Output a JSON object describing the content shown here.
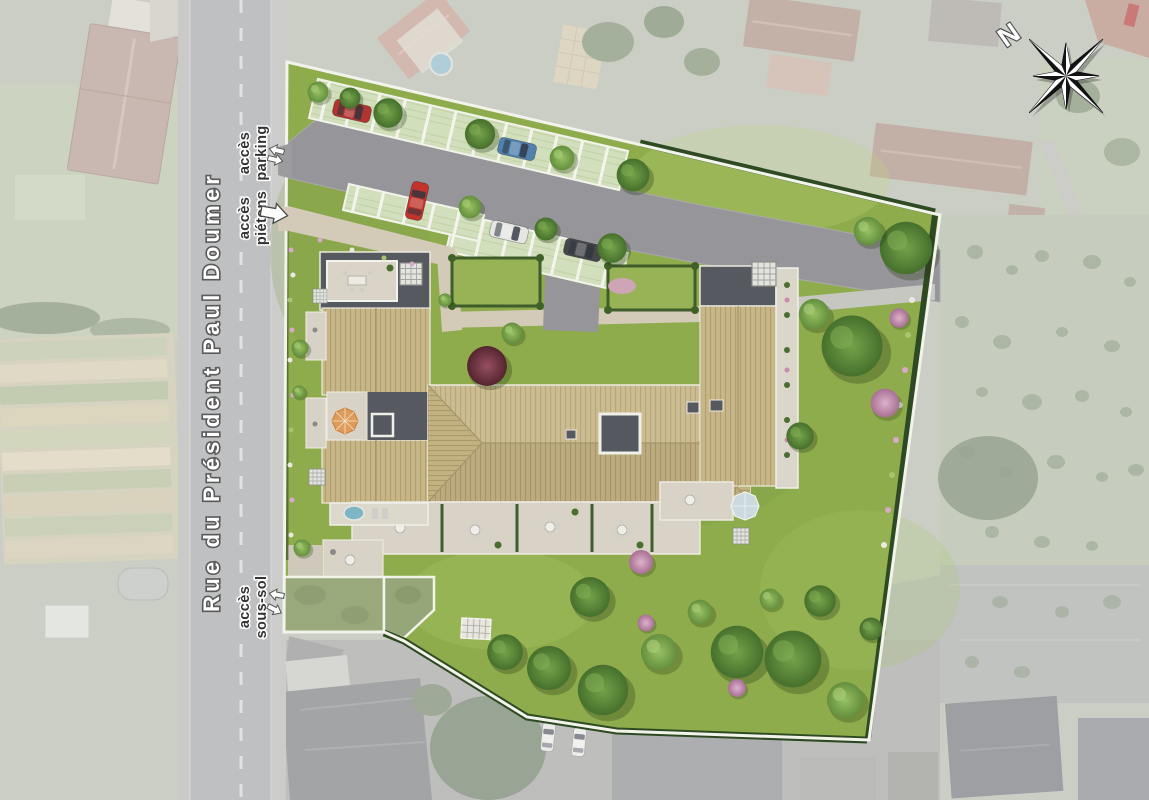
{
  "site_plan": {
    "street_name": "Rue du Président Paul Doumer",
    "access_labels": {
      "parking": [
        "accès",
        "parking"
      ],
      "pedestrian": [
        "accès",
        "piétons"
      ],
      "basement": [
        "accès",
        "sous-sol"
      ]
    },
    "compass": {
      "north_label": "N"
    },
    "palette": {
      "lawn": "#8fac4d",
      "roof_tan": "#c7b687",
      "roof_dark": "#565a60",
      "asphalt": "#95959a",
      "path_beige": "#d3cbb8",
      "boundary_white": "#f2f3ea",
      "hedge_dark": "#2e4a22",
      "faded_surroundings": "#b4b9ac",
      "street_gray": "#a4a5a6"
    },
    "cars": {
      "parking_lot": [
        "red",
        "blue",
        "red",
        "white",
        "black"
      ],
      "street_outside": [
        "white",
        "white"
      ]
    }
  }
}
